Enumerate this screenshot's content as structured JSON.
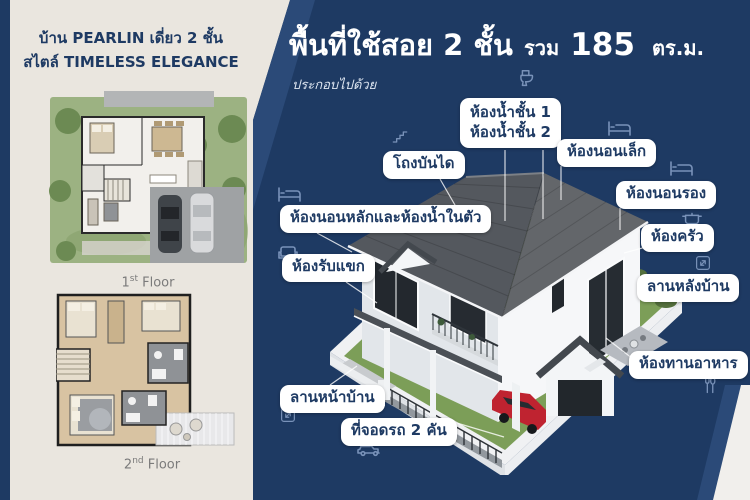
{
  "left_panel": {
    "title_line1": "บ้าน PEARLIN เดี่ยว 2 ชั้น",
    "title_line2": "สไตล์ TIMELESS ELEGANCE",
    "floor1": {
      "num": "1",
      "suffix": "st",
      "word": " Floor"
    },
    "floor2": {
      "num": "2",
      "suffix": "nd",
      "word": " Floor"
    }
  },
  "right_panel": {
    "title": {
      "part1": "พื้นที่ใช้สอย 2 ชั้น",
      "part2": "รวม",
      "part3": "185",
      "part4": "ตร.ม."
    },
    "subtitle": "ประกอบไปด้วย",
    "callouts": {
      "bathrooms": {
        "line1": "ห้องน้ำชั้น 1",
        "line2": "ห้องน้ำชั้น 2",
        "icon": "toilet-icon"
      },
      "stair_hall": {
        "label": "โถงบันได",
        "icon": "stairs-icon"
      },
      "small_bedroom": {
        "label": "ห้องนอนเล็ก",
        "icon": "bed-icon"
      },
      "second_bedroom": {
        "label": "ห้องนอนรอง",
        "icon": "bed-icon"
      },
      "master_bedroom": {
        "label": "ห้องนอนหลักและห้องน้ำในตัว",
        "icon": "bed-icon"
      },
      "kitchen": {
        "label": "ห้องครัว",
        "icon": "pot-icon"
      },
      "backyard": {
        "label": "ลานหลังบ้าน",
        "icon": "expand-icon"
      },
      "living_room": {
        "label": "ห้องรับแขก",
        "icon": "sofa-icon"
      },
      "dining_room": {
        "label": "ห้องทานอาหาร",
        "icon": "cutlery-icon"
      },
      "front_yard": {
        "label": "ลานหน้าบ้าน",
        "icon": "expand-icon"
      },
      "parking": {
        "label": "ที่จอดรถ 2 คัน",
        "icon": "car-icon"
      }
    }
  },
  "colors": {
    "navy": "#1e3a63",
    "navy_light": "#2b4a78",
    "cream": "#eae6df",
    "label_bg": "#ffffff",
    "roof_dark": "#54585e",
    "roof_light": "#63666a",
    "grass": "#7c9e58",
    "car_red": "#bf2330",
    "white_corner": "#f1efec"
  }
}
